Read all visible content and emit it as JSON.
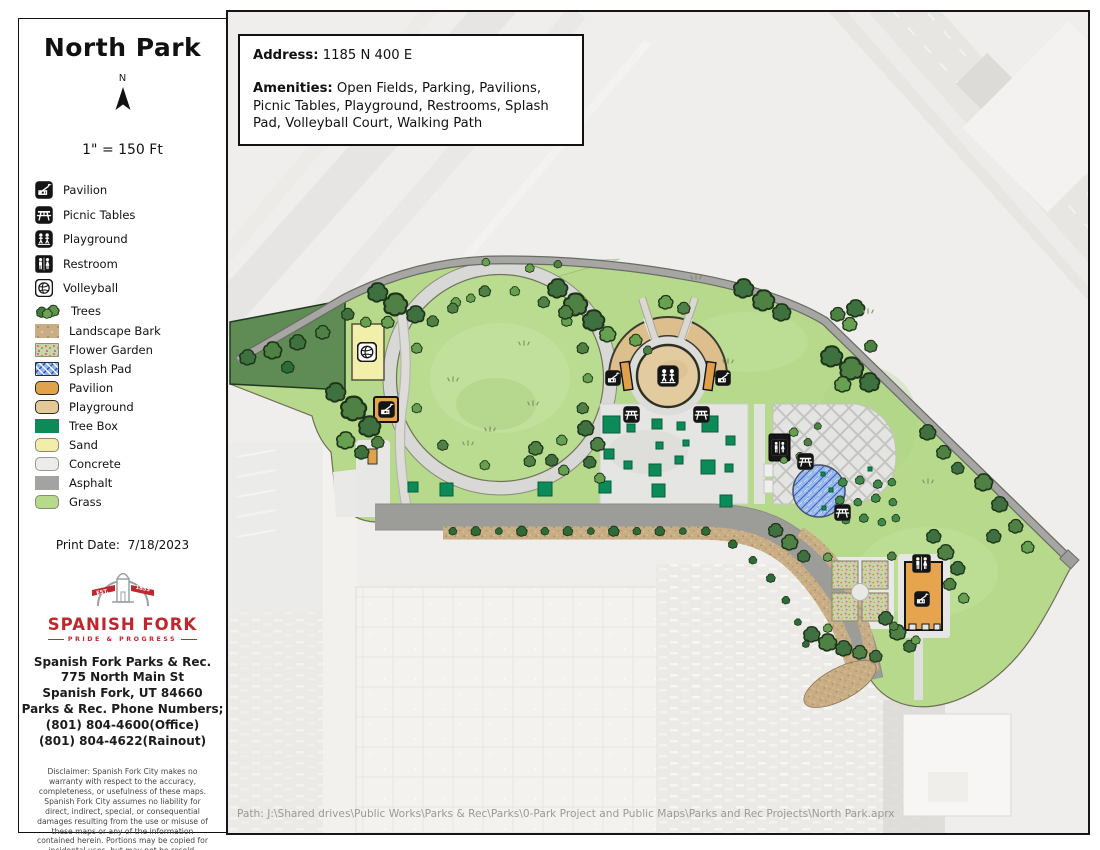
{
  "sidebar": {
    "title": "North Park",
    "north_label": "N",
    "scale_text": "1\" = 150 Ft",
    "legend": {
      "items": [
        {
          "label": "Pavilion",
          "swatch": "icon-pavilion"
        },
        {
          "label": "Picnic Tables",
          "swatch": "icon-picnic-table"
        },
        {
          "label": "Playground",
          "swatch": "icon-playground"
        },
        {
          "label": "Restroom",
          "swatch": "icon-restroom"
        },
        {
          "label": "Volleyball",
          "swatch": "icon-volleyball"
        },
        {
          "label": "Trees",
          "swatch": "trees"
        },
        {
          "label": "Landscape Bark",
          "swatch": "landscape-bark"
        },
        {
          "label": "Flower Garden",
          "swatch": "flower-garden"
        },
        {
          "label": "Splash Pad",
          "swatch": "splash-pad"
        },
        {
          "label": "Pavilion",
          "swatch": "pavilion-fill"
        },
        {
          "label": "Playground",
          "swatch": "playground-fill"
        },
        {
          "label": "Tree Box",
          "swatch": "tree-box"
        },
        {
          "label": "Sand",
          "swatch": "sand"
        },
        {
          "label": "Concrete",
          "swatch": "concrete"
        },
        {
          "label": "Asphalt",
          "swatch": "asphalt"
        },
        {
          "label": "Grass",
          "swatch": "grass"
        }
      ]
    },
    "print_date_label": "Print Date:",
    "print_date_value": "7/18/2023",
    "logo": {
      "est_left": "EST.",
      "est_right": "1855",
      "name": "SPANISH FORK",
      "tagline": "PRIDE & PROGRESS"
    },
    "contact_lines": [
      "Spanish Fork Parks & Rec.",
      "775 North Main St",
      "Spanish Fork, UT 84660",
      "Parks & Rec. Phone Numbers;",
      "(801) 804-4600(Office)",
      "(801) 804-4622(Rainout)"
    ],
    "disclaimer": "Disclaimer:  Spanish Fork City makes no warranty with respect to the accuracy, completeness, or usefulness of these maps.  Spanish Fork City assumes no liability for direct, indirect, special, or consequential damages resulting from the use or misuse of these maps or any of the information contained herein.  Portions may be copied for incidental uses, but may not be resold."
  },
  "info_box": {
    "address_label": "Address:",
    "address_value": "1185 N 400 E",
    "amenities_label": "Amenities:",
    "amenities_value": "Open Fields, Parking, Pavilions, Picnic Tables, Playground, Restrooms, Splash Pad, Volleyball Court, Walking Path"
  },
  "footer": {
    "path_text": "Path: J:\\Shared drives\\Public Works\\Parks & Rec\\Parks\\0-Park Project and Public Maps\\Parks and Rec Projects\\North Park.aprx"
  },
  "colors": {
    "grass": "#b6d98c",
    "asphalt": "#9c9c99",
    "concrete": "#e5e5e3",
    "sand": "#f2eeaa",
    "tree_box": "#0c8a57",
    "pavilion": "#e5a44d",
    "playground_fill": "#e2cb9e",
    "landscape_bark": "#c9ae85",
    "splash_pad_light": "#9cb9ec",
    "splash_pad_dark": "#3e6cc8",
    "logo_red": "#c0272d",
    "icon_black": "#141414"
  }
}
